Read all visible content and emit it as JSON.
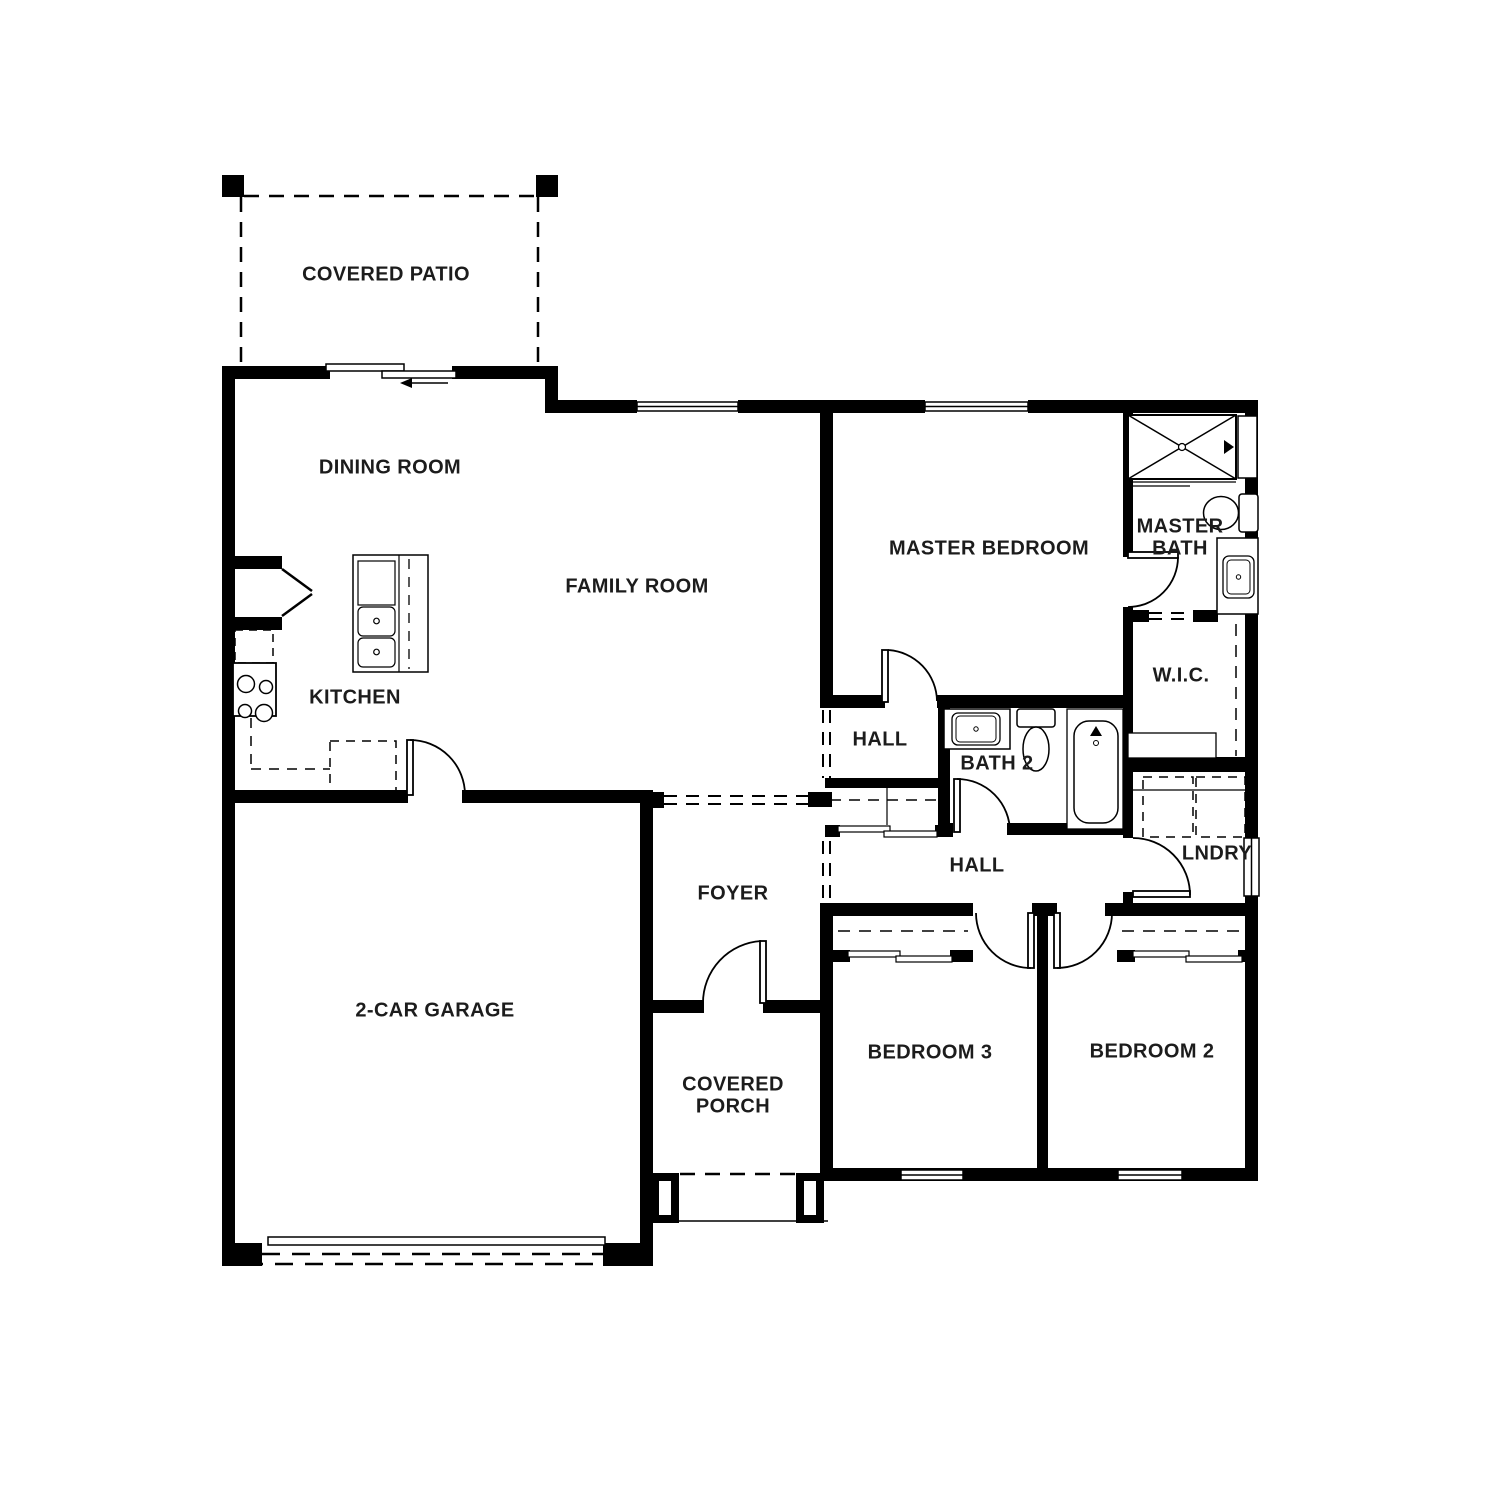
{
  "meta": {
    "drawing_type": "single-story residential floor plan",
    "colors": {
      "wall": "#000000",
      "text": "#1c1c1c",
      "background": "#ffffff"
    }
  },
  "rooms": [
    {
      "id": "covered-patio",
      "label": "COVERED PATIO"
    },
    {
      "id": "dining-room",
      "label": "DINING ROOM"
    },
    {
      "id": "family-room",
      "label": "FAMILY ROOM"
    },
    {
      "id": "kitchen",
      "label": "KITCHEN"
    },
    {
      "id": "master-bedroom",
      "label": "MASTER BEDROOM"
    },
    {
      "id": "master-bath",
      "label": "MASTER BATH"
    },
    {
      "id": "wic",
      "label": "W.I.C."
    },
    {
      "id": "hall-upper",
      "label": "HALL"
    },
    {
      "id": "bath-2",
      "label": "BATH 2"
    },
    {
      "id": "hall-lower",
      "label": "HALL"
    },
    {
      "id": "laundry",
      "label": "LNDRY"
    },
    {
      "id": "foyer",
      "label": "FOYER"
    },
    {
      "id": "garage",
      "label": "2-CAR GARAGE"
    },
    {
      "id": "covered-porch",
      "label": "COVERED PORCH"
    },
    {
      "id": "bedroom-3",
      "label": "BEDROOM 3"
    },
    {
      "id": "bedroom-2",
      "label": "BEDROOM 2"
    }
  ],
  "fixtures": [
    "shower",
    "toilet",
    "vanity-sink",
    "bathtub",
    "kitchen-island-double-sink",
    "range-cooktop",
    "refrigerator",
    "dishwasher",
    "washer",
    "dryer",
    "closet-rods",
    "sliding-patio-door",
    "garage-door",
    "porch-columns"
  ]
}
